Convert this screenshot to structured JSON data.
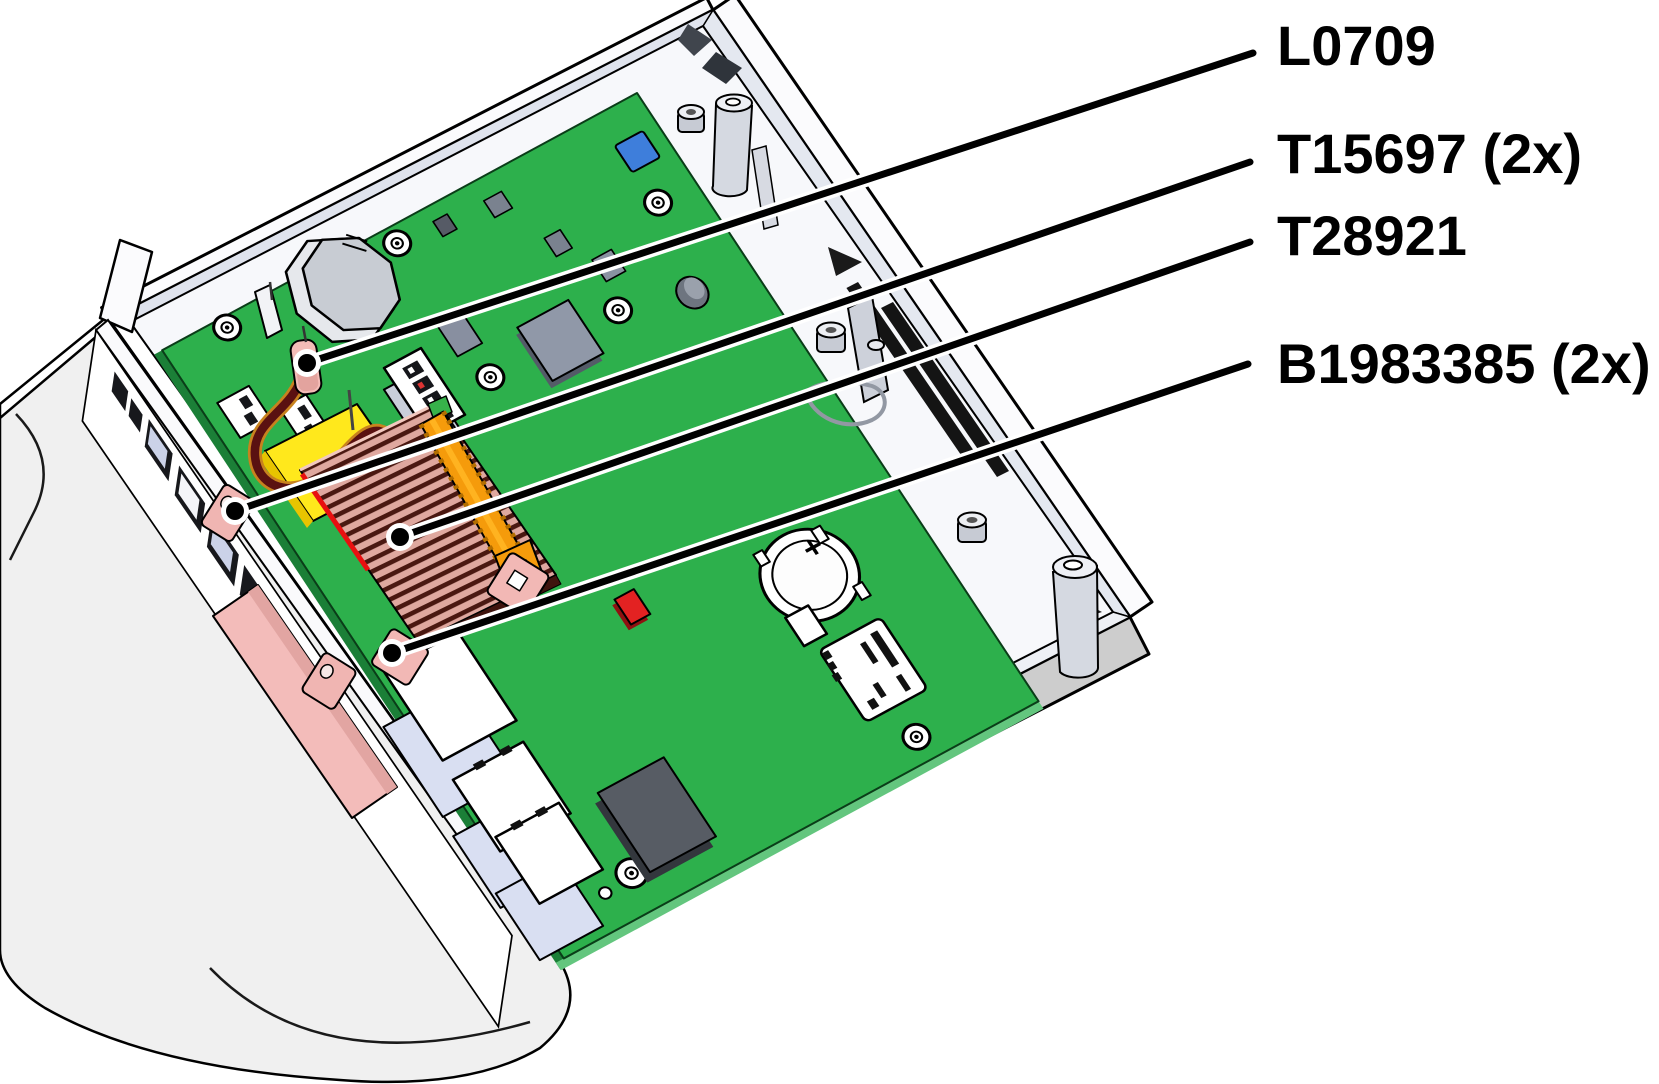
{
  "diagram": {
    "kind": "hardware-service-callout-illustration",
    "device": "set-top-box chassis opened, mainboard visible",
    "callouts": [
      {
        "label": "L0709",
        "target": "wire-terminal-inductor"
      },
      {
        "label": "T15697 (2x)",
        "target": "pink-standoff-block"
      },
      {
        "label": "T28921",
        "target": "finned-heatsink"
      },
      {
        "label": "B1983385 (2x)",
        "target": "heatsink-retainer-bracket"
      }
    ],
    "colors": {
      "pcb_green": "#2DB04C",
      "pcb_edge_dark": "#1B7F37",
      "case_gray": "#F0F0F0",
      "band_gray": "#CDCDCD",
      "heatsink_fin_dark": "#4A1811",
      "heatsink_fin_light": "#DFA89F",
      "retainer_orange": "#F59B0B",
      "part_pink": "#F2B8B5",
      "wire_maroon": "#5A1111",
      "cap_yellow": "#FFE81C",
      "chip_blue": "#3E7EDB",
      "component_red": "#E32222",
      "line_black": "#000000"
    }
  }
}
